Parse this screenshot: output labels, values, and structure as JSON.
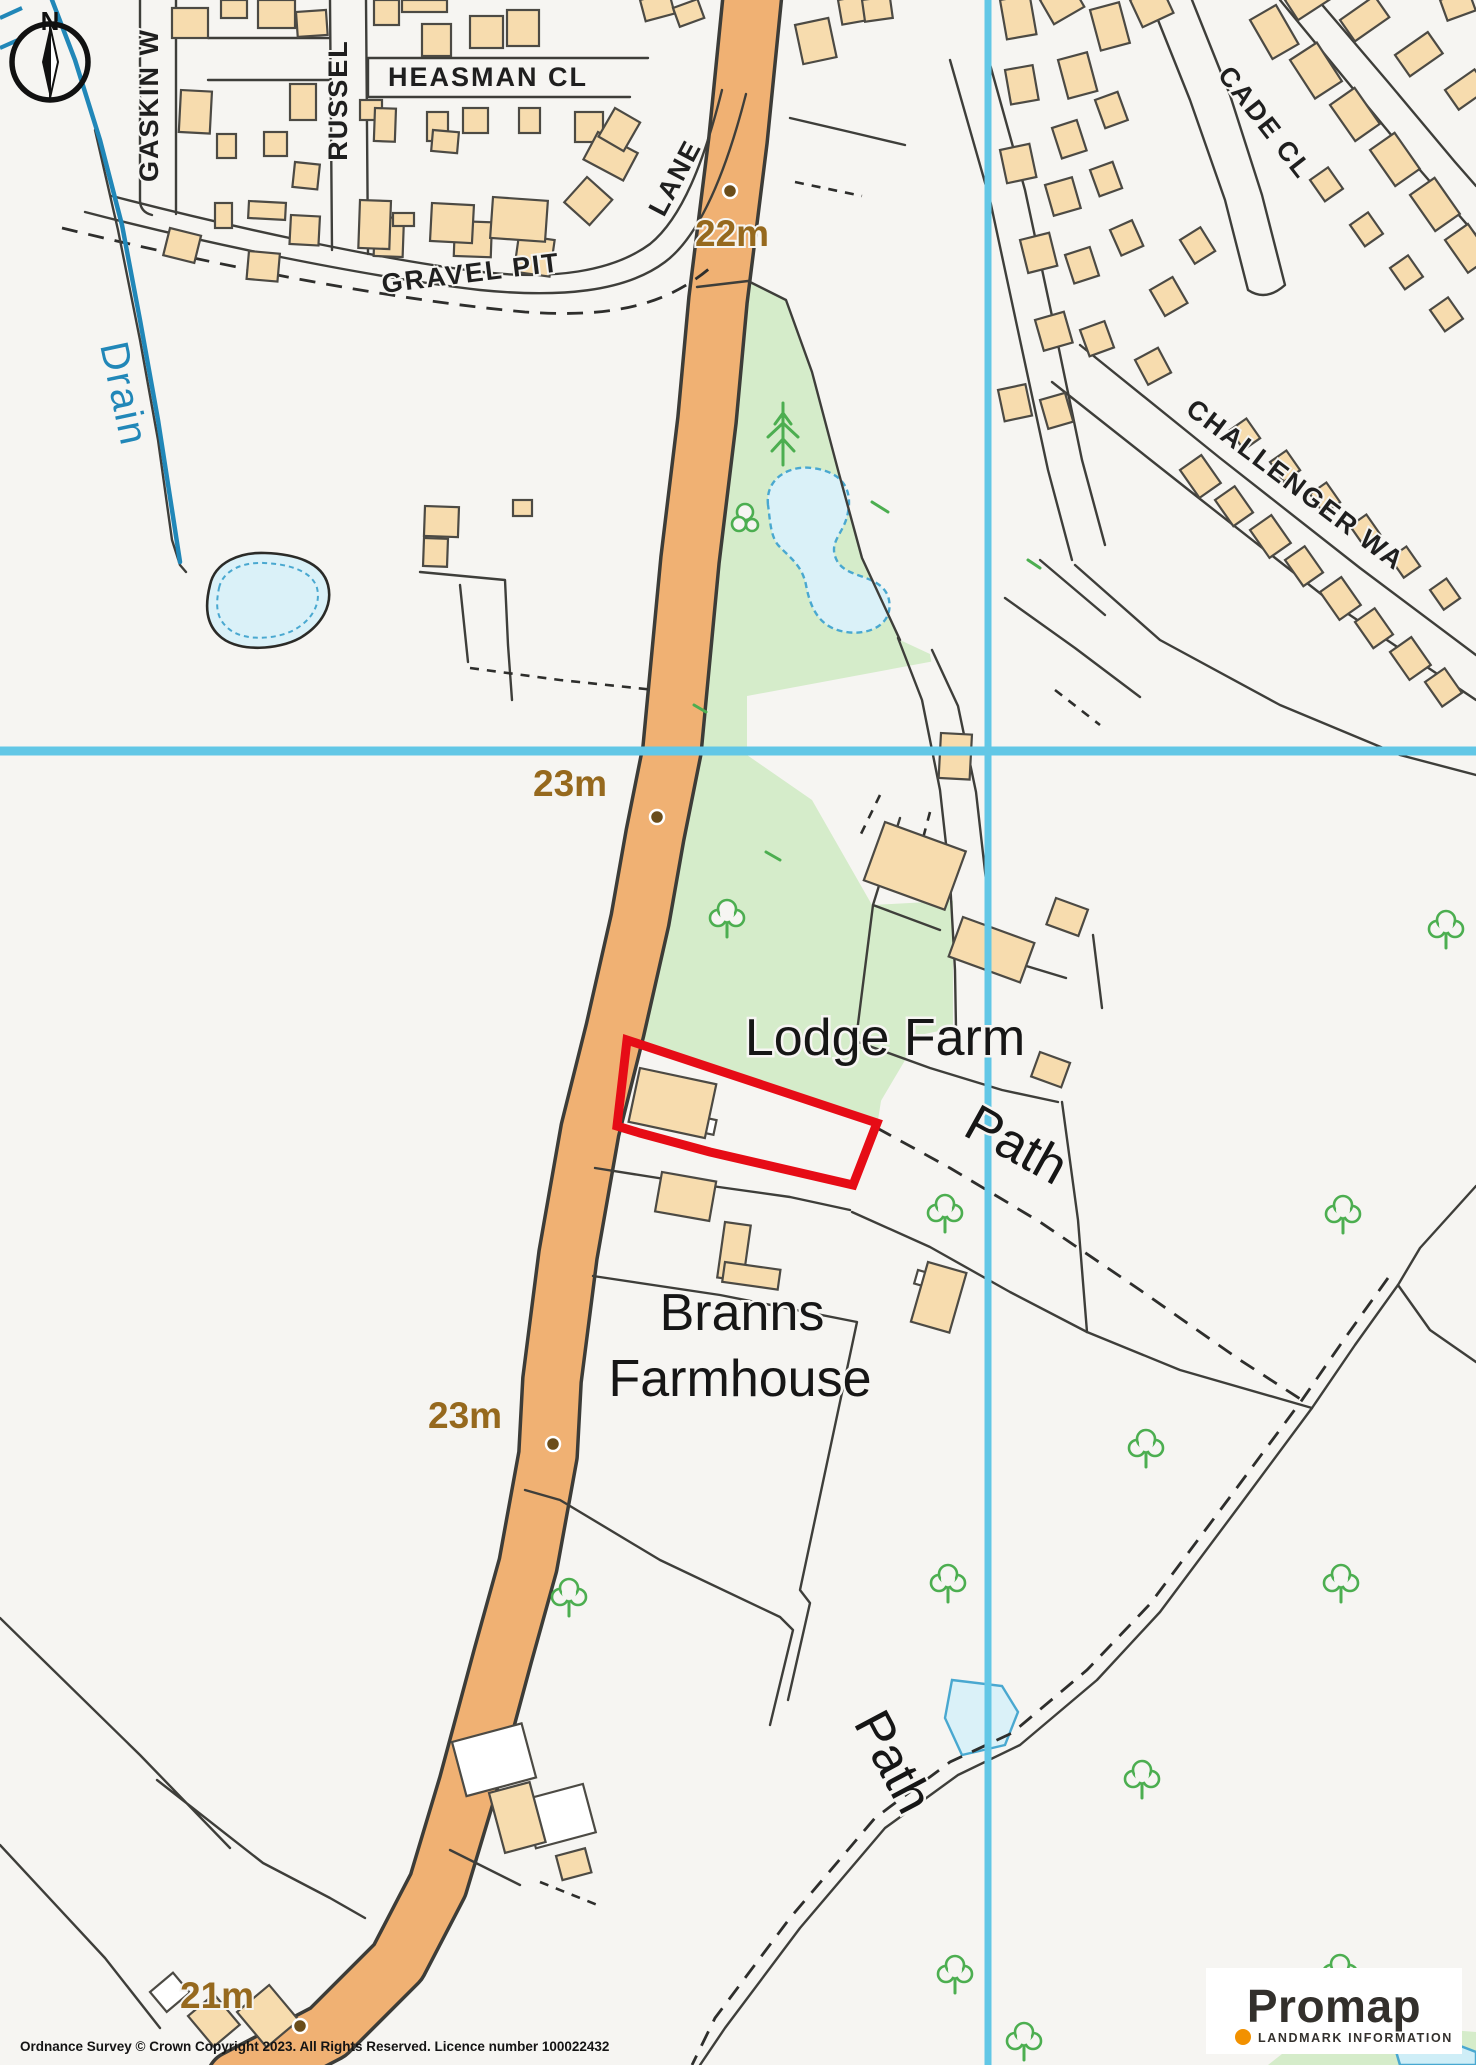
{
  "map": {
    "compass": {
      "label": "N"
    },
    "streets": {
      "gaskin": "GASKIN W",
      "russell": "RUSSEL",
      "heasman": "HEASMAN CL",
      "gravel_pit": "GRAVEL PIT",
      "gravel_pit_lane": "LANE",
      "cade_close": "CADE CL",
      "challenger_way": "CHALLENGER WA"
    },
    "places": {
      "lodge_farm": "Lodge Farm",
      "branns_line1": "Branns",
      "branns_line2": "Farmhouse",
      "path_upper": "Path",
      "path_lower": "Path",
      "drain": "Drain"
    },
    "elevations": {
      "e22": "22m",
      "e23a": "23m",
      "e23b": "23m",
      "e21": "21m"
    },
    "attribution": "Ordnance Survey © Crown Copyright 2023. All Rights Reserved. Licence number 100022432",
    "logo": {
      "brand": "Promap",
      "subtitle": "LANDMARK INFORMATION"
    },
    "colors": {
      "road_orange": "#f0b173",
      "building_tan": "#f7dcae",
      "green_space": "#d5ecca",
      "water_blue": "#daf1f8",
      "water_edge": "#49a8d0",
      "crosshair_cyan": "#62c7e6",
      "plot_red": "#e60c16",
      "elevation_brown": "#96691e",
      "drain_blue": "#2187b8"
    }
  }
}
